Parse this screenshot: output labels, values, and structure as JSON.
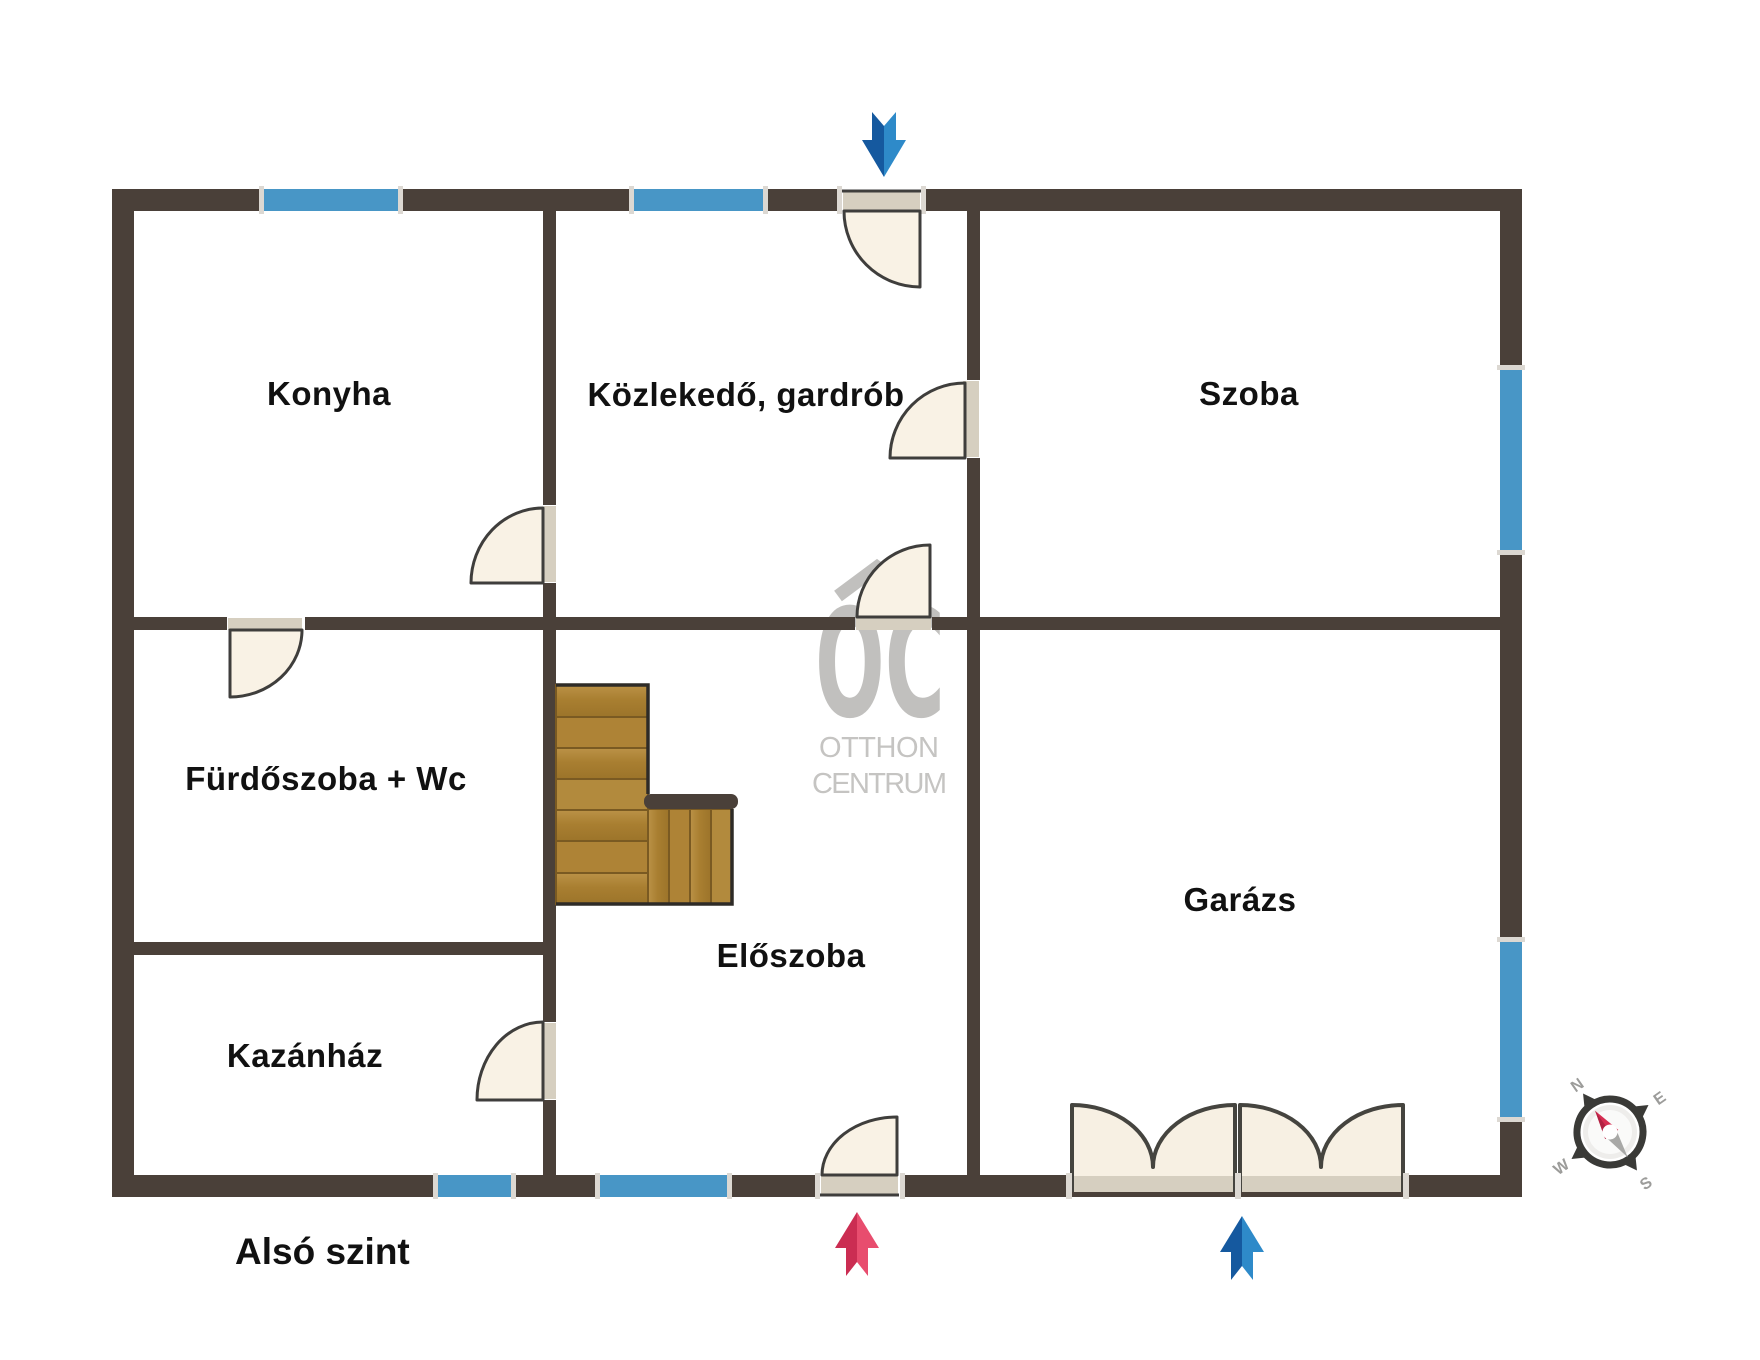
{
  "floor_plan": {
    "floor_label": "Alsó szint",
    "rooms": [
      {
        "label": "Konyha"
      },
      {
        "label": "Közlekedő, gardrób"
      },
      {
        "label": "Szoba"
      },
      {
        "label": "Fürdőszoba + Wc"
      },
      {
        "label": "Előszoba"
      },
      {
        "label": "Kazánház"
      },
      {
        "label": "Garázs"
      }
    ],
    "watermark": {
      "logo": "OC",
      "line1": "OTTHON",
      "line2": "CENTRUM"
    },
    "compass": {
      "n": "N",
      "e": "E",
      "s": "S",
      "w": "W"
    },
    "colors": {
      "wall": "#4a4039",
      "window_blue": "#4896c6",
      "door_fill": "#f9f2e5",
      "door_band": "#d6cfc0",
      "stair_wood": "#ad8436",
      "arrow_red": "#e0395e",
      "arrow_blue": "#2271b5",
      "watermark_gray": "#c1c0be"
    }
  }
}
